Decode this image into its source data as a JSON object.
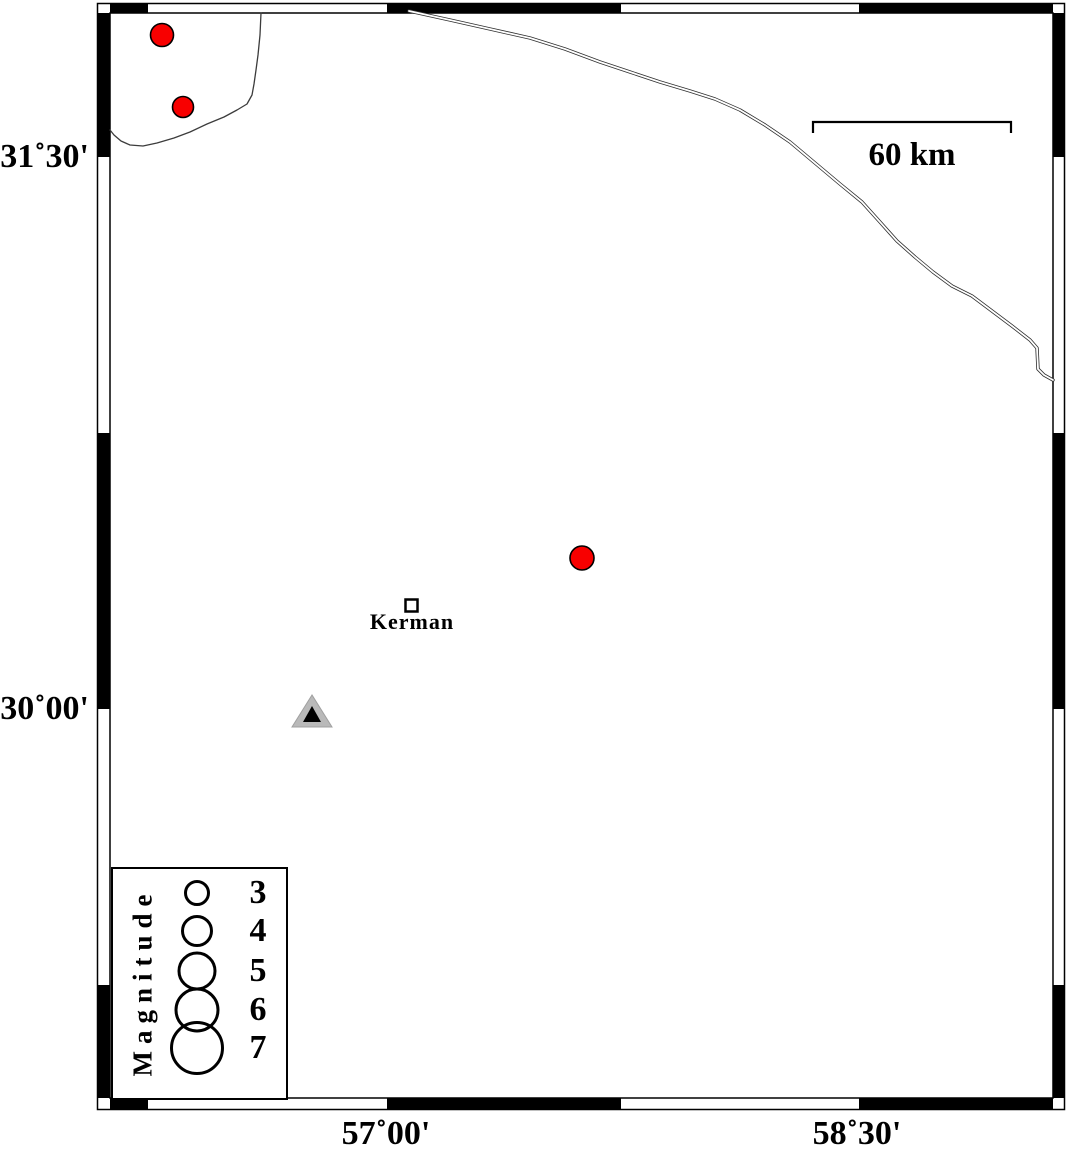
{
  "figure": {
    "description": "Epicenter map of the Kerman region with magnitude legend and 60 km scale bar"
  },
  "axes": {
    "left_ticks": [
      {
        "label": "31˚30'",
        "y_px": 157
      },
      {
        "label": "30˚00'",
        "y_px": 709
      }
    ],
    "bottom_ticks": [
      {
        "label": "57˚00'",
        "x_px": 386
      },
      {
        "label": "58˚30'",
        "x_px": 857
      }
    ]
  },
  "scale_bar": {
    "label": "60 km"
  },
  "city": {
    "label": "Kerman",
    "x_px": 411,
    "y_px": 605
  },
  "station": {
    "x_px": 312,
    "y_px": 712,
    "fill": "#b9b9b9",
    "outer_points": "312,695 292,727 332,727",
    "inner_points": "312,706 303,722 321,722"
  },
  "earthquakes": {
    "color": "#f80000",
    "points": [
      {
        "x_px": 162,
        "y_px": 35,
        "r_px": 11.5
      },
      {
        "x_px": 183,
        "y_px": 107,
        "r_px": 10.5
      },
      {
        "x_px": 582,
        "y_px": 558,
        "r_px": 12
      }
    ]
  },
  "legend": {
    "title": "Magnitude",
    "entries": [
      {
        "label": "3",
        "r_px": 11.5
      },
      {
        "label": "4",
        "r_px": 14.5
      },
      {
        "label": "5",
        "r_px": 18
      },
      {
        "label": "6",
        "r_px": 21
      },
      {
        "label": "7",
        "r_px": 25.5
      }
    ]
  },
  "lines": {
    "boundary_path": "110,130 114,135 121,141 130,145 143,146 157,143 174,138 190,132 207,124 224,117 237,110 247,104 252,95 254,84 256,70 258,55 260,35 261,13",
    "road_path": "409,11 450,20 490,29 530,38 565,49 600,62 630,72 660,82 690,91 715,99 740,110 765,125 790,142 815,163 840,184 862,202 880,222 897,241 915,257 933,272 952,286 972,296 992,311 1012,326 1030,340 1037,348 1038,369 1044,375 1053,380"
  }
}
